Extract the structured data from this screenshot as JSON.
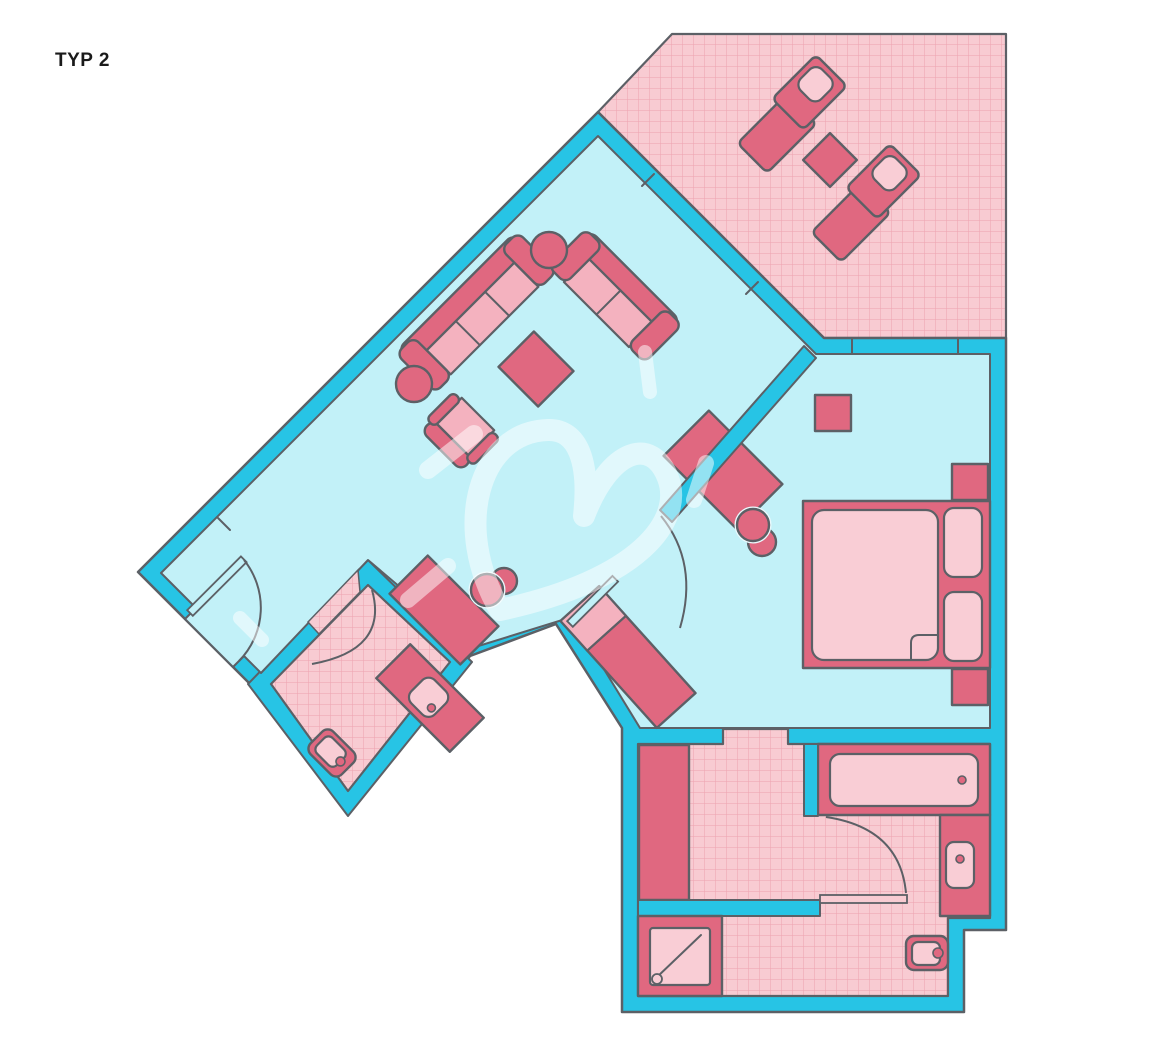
{
  "title": "TYP 2",
  "colors": {
    "background": "#ffffff",
    "wall": "#27c4e5",
    "floor": "#c2f1f8",
    "outline": "#5c6066",
    "furniture_dark": "#e06880",
    "furniture_light": "#f4b2bf",
    "furniture_pale": "#f9cdd5",
    "hatch_bg": "#f8cbd2",
    "hatch_line": "#ea97a6",
    "highlight": "rgba(255,255,255,0.5)",
    "title_color": "#1a1a1a"
  },
  "rooms": [
    "terrace",
    "living-room",
    "hall",
    "bedroom",
    "bathroom",
    "wc"
  ],
  "furniture": [
    "sun-lounger",
    "terrace-table",
    "sofa-large",
    "sofa-small",
    "coffee-table",
    "armchair",
    "side-table",
    "sideboard",
    "hall-chair",
    "wardrobe",
    "desk",
    "desk-chair",
    "stool",
    "double-bed",
    "nightstand",
    "bathtub",
    "washbasin",
    "toilet",
    "shower",
    "wc-vanity"
  ]
}
